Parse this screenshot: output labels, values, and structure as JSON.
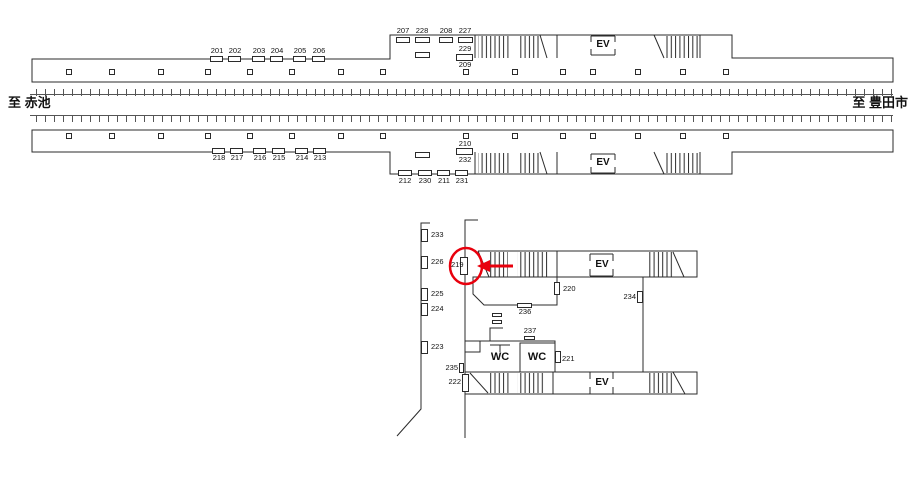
{
  "map_title": "station sign location map",
  "colors": {
    "line": "#2b2b2b",
    "track": "#555555",
    "highlight_red": "#e8000d"
  },
  "directions": {
    "left": "至 赤池",
    "right": "至 豊田市"
  },
  "highlight": {
    "circled_sign": "219"
  },
  "ev_label": "EV",
  "wc_label": "WC",
  "labels": [
    {
      "t": "201",
      "x": 217,
      "y": 47
    },
    {
      "t": "202",
      "x": 235,
      "y": 47
    },
    {
      "t": "203",
      "x": 259,
      "y": 47
    },
    {
      "t": "204",
      "x": 277,
      "y": 47
    },
    {
      "t": "205",
      "x": 300,
      "y": 47
    },
    {
      "t": "206",
      "x": 319,
      "y": 47
    },
    {
      "t": "207",
      "x": 403,
      "y": 27
    },
    {
      "t": "228",
      "x": 422,
      "y": 27
    },
    {
      "t": "208",
      "x": 446,
      "y": 27
    },
    {
      "t": "227",
      "x": 465,
      "y": 27
    },
    {
      "t": "229",
      "x": 465,
      "y": 45
    },
    {
      "t": "209",
      "x": 465,
      "y": 61
    },
    {
      "t": "218",
      "x": 219,
      "y": 154
    },
    {
      "t": "217",
      "x": 237,
      "y": 154
    },
    {
      "t": "216",
      "x": 260,
      "y": 154
    },
    {
      "t": "215",
      "x": 279,
      "y": 154
    },
    {
      "t": "214",
      "x": 302,
      "y": 154
    },
    {
      "t": "213",
      "x": 320,
      "y": 154
    },
    {
      "t": "212",
      "x": 405,
      "y": 177
    },
    {
      "t": "230",
      "x": 425,
      "y": 177
    },
    {
      "t": "211",
      "x": 444,
      "y": 177
    },
    {
      "t": "231",
      "x": 462,
      "y": 177
    },
    {
      "t": "210",
      "x": 465,
      "y": 140
    },
    {
      "t": "232",
      "x": 465,
      "y": 156
    },
    {
      "t": "233",
      "x": 431,
      "y": 231,
      "a": "l"
    },
    {
      "t": "226",
      "x": 431,
      "y": 258,
      "a": "l"
    },
    {
      "t": "225",
      "x": 431,
      "y": 290,
      "a": "l"
    },
    {
      "t": "224",
      "x": 431,
      "y": 305,
      "a": "l"
    },
    {
      "t": "223",
      "x": 431,
      "y": 343,
      "a": "l"
    },
    {
      "t": "219",
      "x": 451,
      "y": 261,
      "a": "l"
    },
    {
      "t": "220",
      "x": 563,
      "y": 285,
      "a": "l"
    },
    {
      "t": "236",
      "x": 525,
      "y": 308
    },
    {
      "t": "237",
      "x": 530,
      "y": 327
    },
    {
      "t": "234",
      "x": 636,
      "y": 293,
      "a": "r"
    },
    {
      "t": "235",
      "x": 458,
      "y": 364,
      "a": "r"
    },
    {
      "t": "222",
      "x": 461,
      "y": 378,
      "a": "r"
    },
    {
      "t": "221",
      "x": 562,
      "y": 355,
      "a": "l"
    },
    {
      "t": "至 赤池",
      "x": 8,
      "y": 96,
      "a": "l",
      "s": 13,
      "b": 1,
      "n": "direction-left"
    },
    {
      "t": "至 豊田市",
      "x": 908,
      "y": 96,
      "a": "r",
      "s": 13,
      "b": 1,
      "n": "direction-right"
    },
    {
      "t": "EV",
      "x": 603,
      "y": 40,
      "s": 10,
      "b": 1,
      "n": "elevator-label-platform1"
    },
    {
      "t": "EV",
      "x": 603,
      "y": 158,
      "s": 10,
      "b": 1,
      "n": "elevator-label-platform2"
    },
    {
      "t": "EV",
      "x": 602,
      "y": 260,
      "s": 10,
      "b": 1,
      "n": "elevator-label-concourse-top"
    },
    {
      "t": "EV",
      "x": 602,
      "y": 378,
      "s": 10,
      "b": 1,
      "n": "elevator-label-concourse-bottom"
    },
    {
      "t": "WC",
      "x": 500,
      "y": 352,
      "s": 11,
      "b": 1,
      "n": "wc-label-left"
    },
    {
      "t": "WC",
      "x": 537,
      "y": 352,
      "s": 11,
      "b": 1,
      "n": "wc-label-right"
    }
  ],
  "markers": [
    [
      210,
      56,
      13,
      6,
      "marker-201"
    ],
    [
      228,
      56,
      13,
      6,
      "marker-202"
    ],
    [
      252,
      56,
      13,
      6,
      "marker-203"
    ],
    [
      270,
      56,
      13,
      6,
      "marker-204"
    ],
    [
      293,
      56,
      13,
      6,
      "marker-205"
    ],
    [
      312,
      56,
      13,
      6,
      "marker-206"
    ],
    [
      396,
      37,
      14,
      6,
      "marker-207"
    ],
    [
      415,
      37,
      15,
      6,
      "marker-228"
    ],
    [
      439,
      37,
      14,
      6,
      "marker-208"
    ],
    [
      458,
      37,
      15,
      6,
      "marker-227"
    ],
    [
      415,
      52,
      15,
      6,
      "marker-misc-p1"
    ],
    [
      456,
      54,
      17,
      7,
      "marker-229-209"
    ],
    [
      212,
      148,
      13,
      6,
      "marker-218"
    ],
    [
      230,
      148,
      13,
      6,
      "marker-217"
    ],
    [
      253,
      148,
      13,
      6,
      "marker-216"
    ],
    [
      272,
      148,
      13,
      6,
      "marker-215"
    ],
    [
      295,
      148,
      13,
      6,
      "marker-214"
    ],
    [
      313,
      148,
      13,
      6,
      "marker-213"
    ],
    [
      398,
      170,
      14,
      6,
      "marker-212"
    ],
    [
      418,
      170,
      14,
      6,
      "marker-230"
    ],
    [
      437,
      170,
      13,
      6,
      "marker-211"
    ],
    [
      455,
      170,
      13,
      6,
      "marker-231"
    ],
    [
      415,
      152,
      15,
      6,
      "marker-misc-p2"
    ],
    [
      456,
      148,
      17,
      7,
      "marker-210-232"
    ],
    [
      421,
      229,
      7,
      13,
      "marker-233"
    ],
    [
      421,
      256,
      7,
      13,
      "marker-226"
    ],
    [
      421,
      288,
      7,
      13,
      "marker-225"
    ],
    [
      421,
      303,
      7,
      13,
      "marker-224"
    ],
    [
      421,
      341,
      7,
      13,
      "marker-223"
    ],
    [
      460,
      257,
      8,
      18,
      "marker-219"
    ],
    [
      554,
      282,
      6,
      13,
      "marker-220"
    ],
    [
      517,
      303,
      15,
      5,
      "marker-236"
    ],
    [
      492,
      313,
      10,
      4,
      "marker-equip-1"
    ],
    [
      492,
      320,
      10,
      4,
      "marker-equip-2"
    ],
    [
      524,
      336,
      11,
      4,
      "marker-237"
    ],
    [
      637,
      291,
      6,
      12,
      "marker-234"
    ],
    [
      459,
      363,
      5,
      10,
      "marker-235"
    ],
    [
      555,
      351,
      6,
      12,
      "marker-221"
    ],
    [
      462,
      374,
      7,
      18,
      "marker-222"
    ]
  ],
  "pillars": {
    "xs": [
      66,
      109,
      158,
      205,
      247,
      289,
      338,
      380,
      463,
      512,
      560,
      590,
      635,
      680,
      723
    ],
    "rows": [
      69,
      133
    ],
    "size": 6
  }
}
